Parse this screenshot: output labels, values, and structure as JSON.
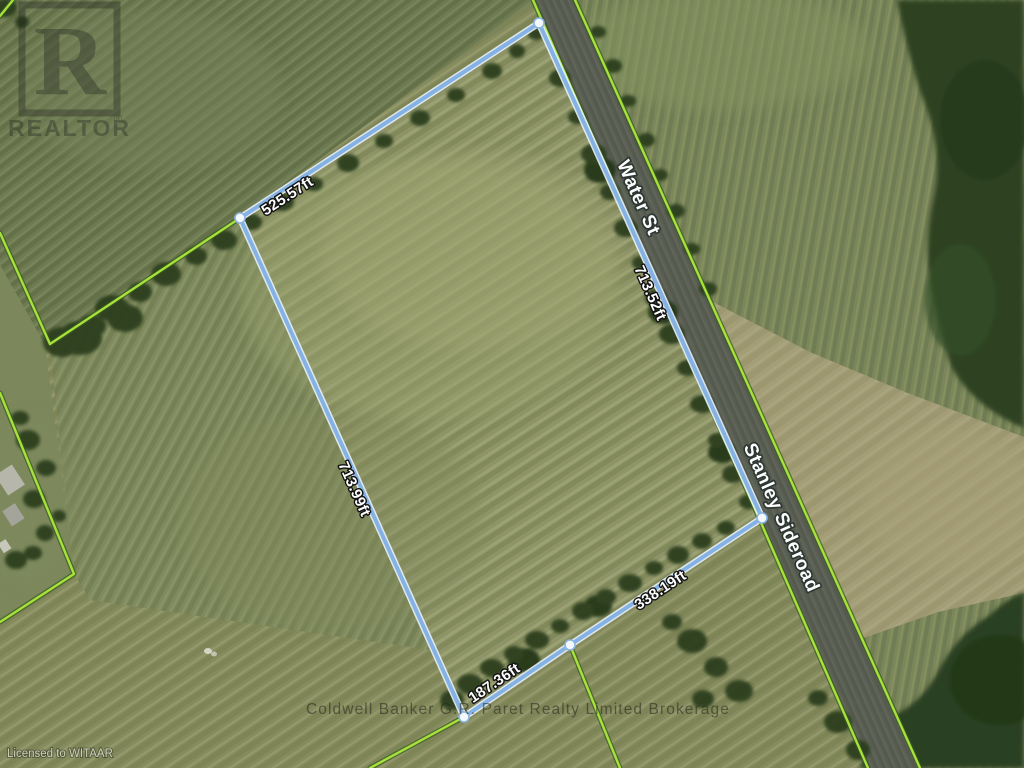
{
  "streets": {
    "water_st": "Water St",
    "stanley_sideroad": "Stanley Sideroad"
  },
  "boundary": {
    "nw": "525.57ft",
    "ne_road": "713.52ft",
    "west": "713.99ft",
    "se_road": "338.19ft",
    "south": "187.36ft"
  },
  "watermarks": {
    "logo_letter": "R",
    "logo_text": "REALTOR",
    "registered": "®",
    "brokerage": "Coldwell Banker G.R. Paret Realty Limited Brokerage",
    "license": "Licensed to WITAAR"
  },
  "colors": {
    "boundary_line": "#85b2e4",
    "boundary_casing": "#eaf2fb",
    "parcel_line": "#a6e23b",
    "parcel_line_dark": "#3a5a20",
    "road": "#5b6054"
  }
}
